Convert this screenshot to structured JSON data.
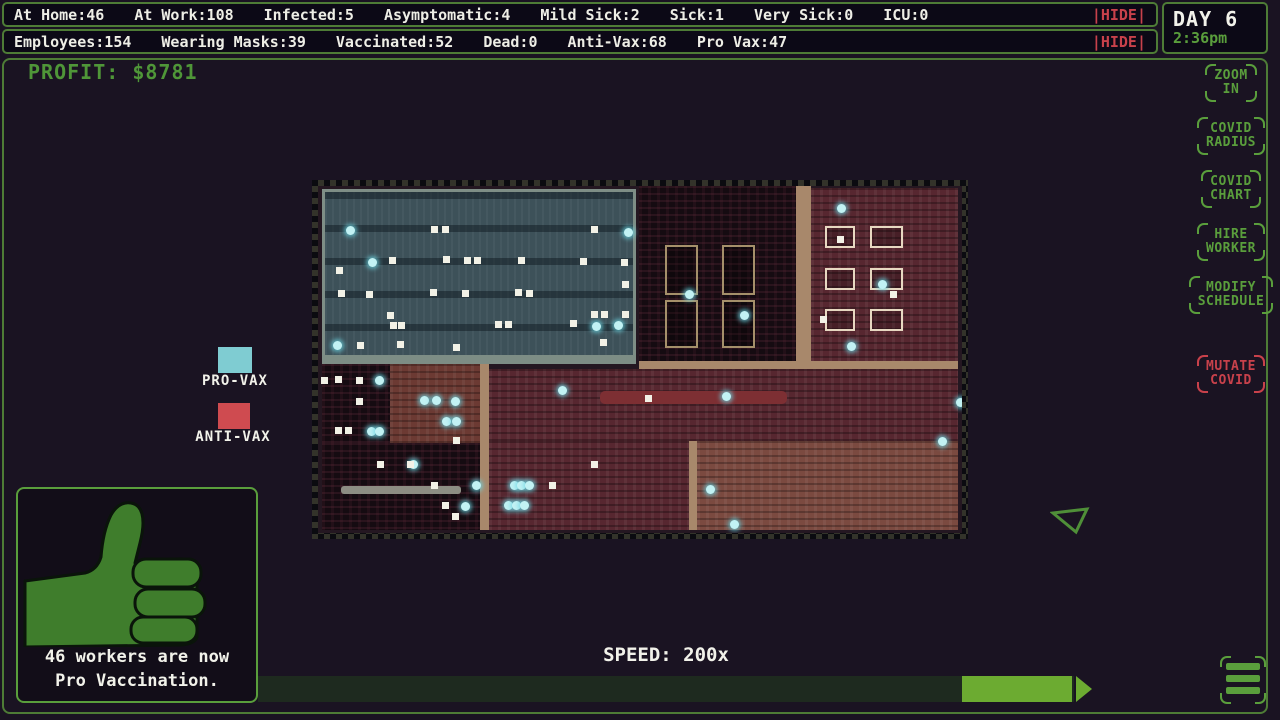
{
  "colors": {
    "accent_green": "#5a9e3c",
    "frame_green": "#4e7c36",
    "danger_red": "#c8414b",
    "profit_green": "#4f9638",
    "provax_cyan": "#7fccd2",
    "antivax_red": "#cf4b50",
    "speed_handle_green": "#6cab31"
  },
  "topbar1": {
    "stats": [
      "At Home:46",
      "At Work:108",
      "Infected:5",
      "Asymptomatic:4",
      "Mild Sick:2",
      "Sick:1",
      "Very Sick:0",
      "ICU:0"
    ],
    "hide_label": "|HIDE|"
  },
  "topbar2": {
    "stats": [
      "Employees:154",
      "Wearing Masks:39",
      "Vaccinated:52",
      "Dead:0",
      "Anti-Vax:68",
      "Pro Vax:47"
    ],
    "hide_label": "|HIDE|"
  },
  "clock": {
    "day": "DAY 6",
    "time": "2:36pm"
  },
  "profit": {
    "label": "PROFIT: $8781"
  },
  "legend": {
    "provax": "PRO-VAX",
    "antivax": "ANTI-VAX"
  },
  "buttons": [
    {
      "label": "ZOOM\nIN"
    },
    {
      "label": "COVID\nRADIUS"
    },
    {
      "label": "COVID\nCHART"
    },
    {
      "label": "HIRE\nWORKER"
    },
    {
      "label": "MODIFY\nSCHEDULE"
    },
    {
      "label": "MUTATE\nCOVID",
      "danger": true
    }
  ],
  "notification": {
    "icon": "thumbs-up-icon",
    "message": "46 workers are now\nPro Vaccination."
  },
  "speed": {
    "label": "SPEED: 200x"
  },
  "menu_icon": "hamburger-icon",
  "map": {
    "rooms": [
      {
        "x": 0.6,
        "y": 1.0,
        "w": 48.8,
        "h": 49.2,
        "t": "blue"
      },
      {
        "x": 49.8,
        "y": 0.0,
        "w": 24.4,
        "h": 50.4,
        "t": "dark"
      },
      {
        "x": 0.6,
        "y": 48.6,
        "w": 48.8,
        "h": 2.6,
        "t": "sidewalk"
      },
      {
        "x": 74.2,
        "y": 0.0,
        "w": 2.4,
        "h": 51.0,
        "t": "tan"
      },
      {
        "x": 76.6,
        "y": 0.6,
        "w": 22.8,
        "h": 49.8,
        "t": "maroon"
      },
      {
        "x": 49.8,
        "y": 50.4,
        "w": 49.6,
        "h": 2.2,
        "t": "tan"
      },
      {
        "x": 0.6,
        "y": 51.2,
        "w": 10.6,
        "h": 23.0,
        "t": "dark"
      },
      {
        "x": 11.2,
        "y": 51.2,
        "w": 14.0,
        "h": 23.0,
        "t": "red"
      },
      {
        "x": 25.2,
        "y": 51.2,
        "w": 1.4,
        "h": 48.0,
        "t": "tan"
      },
      {
        "x": 26.6,
        "y": 52.6,
        "w": 72.8,
        "h": 21.0,
        "t": "maroon"
      },
      {
        "x": 0.6,
        "y": 74.2,
        "w": 24.6,
        "h": 25.0,
        "t": "dark"
      },
      {
        "x": 26.6,
        "y": 73.6,
        "w": 31.0,
        "h": 25.6,
        "t": "maroon"
      },
      {
        "x": 57.6,
        "y": 73.6,
        "w": 1.2,
        "h": 25.6,
        "t": "tan"
      },
      {
        "x": 58.8,
        "y": 73.6,
        "w": 40.6,
        "h": 25.6,
        "t": "brown"
      }
    ],
    "structures": [
      {
        "x": 53.9,
        "y": 17.0,
        "w": 5.1,
        "h": 14.4,
        "s": "khaki"
      },
      {
        "x": 62.7,
        "y": 17.0,
        "w": 5.1,
        "h": 14.4,
        "s": "khaki"
      },
      {
        "x": 53.9,
        "y": 32.9,
        "w": 5.1,
        "h": 13.8,
        "s": "khaki"
      },
      {
        "x": 62.7,
        "y": 32.9,
        "w": 5.1,
        "h": 13.8,
        "s": "khaki"
      },
      {
        "x": 78.7,
        "y": 11.5,
        "w": 4.7,
        "h": 6.3,
        "s": "white"
      },
      {
        "x": 85.7,
        "y": 11.5,
        "w": 5.1,
        "h": 6.3,
        "s": "white"
      },
      {
        "x": 78.7,
        "y": 23.6,
        "w": 4.7,
        "h": 6.3,
        "s": "white"
      },
      {
        "x": 85.7,
        "y": 23.6,
        "w": 5.1,
        "h": 6.3,
        "s": "white"
      },
      {
        "x": 78.7,
        "y": 35.4,
        "w": 4.7,
        "h": 6.3,
        "s": "white"
      },
      {
        "x": 85.7,
        "y": 35.4,
        "w": 5.1,
        "h": 6.3,
        "s": "white"
      },
      {
        "x": 43.8,
        "y": 59.0,
        "w": 29.0,
        "h": 3.8,
        "s": "couch"
      },
      {
        "x": 3.6,
        "y": 86.5,
        "w": 18.6,
        "h": 2.2,
        "s": "gray"
      }
    ],
    "dots": [
      [
        4.3,
        11.5,
        "c"
      ],
      [
        47.5,
        12.1,
        "c"
      ],
      [
        7.8,
        20.7,
        "c"
      ],
      [
        46.0,
        38.9,
        "c"
      ],
      [
        2.3,
        44.7,
        "c"
      ],
      [
        42.5,
        39.2,
        "c"
      ],
      [
        57.0,
        30.0,
        "c"
      ],
      [
        65.5,
        36.0,
        "c"
      ],
      [
        80.6,
        5.2,
        "c"
      ],
      [
        87.0,
        27.1,
        "c"
      ],
      [
        82.1,
        45.0,
        "c"
      ],
      [
        8.9,
        54.8,
        "c"
      ],
      [
        7.6,
        69.5,
        "c"
      ],
      [
        8.9,
        69.5,
        "c"
      ],
      [
        15.8,
        60.5,
        "c"
      ],
      [
        17.7,
        60.5,
        "c"
      ],
      [
        20.7,
        60.8,
        "c"
      ],
      [
        19.3,
        66.6,
        "c"
      ],
      [
        20.8,
        66.6,
        "c"
      ],
      [
        14.1,
        79.0,
        "c"
      ],
      [
        23.9,
        85.0,
        "c"
      ],
      [
        22.2,
        91.1,
        "c"
      ],
      [
        37.3,
        57.6,
        "c"
      ],
      [
        29.8,
        85.0,
        "c"
      ],
      [
        30.9,
        85.0,
        "c"
      ],
      [
        32.1,
        85.0,
        "c"
      ],
      [
        28.9,
        90.8,
        "c"
      ],
      [
        30.1,
        90.8,
        "c"
      ],
      [
        31.4,
        90.8,
        "c"
      ],
      [
        62.7,
        59.4,
        "c"
      ],
      [
        60.2,
        86.2,
        "c"
      ],
      [
        64.0,
        96.3,
        "c"
      ],
      [
        96.3,
        72.3,
        "c"
      ],
      [
        99.0,
        61.0,
        "c"
      ],
      [
        17.5,
        11.5,
        "w"
      ],
      [
        19.3,
        11.5,
        "w"
      ],
      [
        42.4,
        11.5,
        "w"
      ],
      [
        11.0,
        20.5,
        "w"
      ],
      [
        19.4,
        20.2,
        "w"
      ],
      [
        22.7,
        20.5,
        "w"
      ],
      [
        24.2,
        20.5,
        "w"
      ],
      [
        31.1,
        20.5,
        "w"
      ],
      [
        40.7,
        20.7,
        "w"
      ],
      [
        47.0,
        21.0,
        "w"
      ],
      [
        2.8,
        23.3,
        "w"
      ],
      [
        47.2,
        27.4,
        "w"
      ],
      [
        3.1,
        30.0,
        "w"
      ],
      [
        7.5,
        30.3,
        "w"
      ],
      [
        17.4,
        29.7,
        "w"
      ],
      [
        22.4,
        30.0,
        "w"
      ],
      [
        30.6,
        29.7,
        "w"
      ],
      [
        32.3,
        30.0,
        "w"
      ],
      [
        10.7,
        36.3,
        "w"
      ],
      [
        11.2,
        39.2,
        "w"
      ],
      [
        12.4,
        39.2,
        "w"
      ],
      [
        27.5,
        38.9,
        "w"
      ],
      [
        29.0,
        38.9,
        "w"
      ],
      [
        39.1,
        38.6,
        "w"
      ],
      [
        42.4,
        36.0,
        "w"
      ],
      [
        43.9,
        36.0,
        "w"
      ],
      [
        47.2,
        36.0,
        "w"
      ],
      [
        6.1,
        45.0,
        "w"
      ],
      [
        12.3,
        44.7,
        "w"
      ],
      [
        21.0,
        45.5,
        "w"
      ],
      [
        43.8,
        44.1,
        "w"
      ],
      [
        80.6,
        14.4,
        "w"
      ],
      [
        88.8,
        30.3,
        "w"
      ],
      [
        0.5,
        55.0,
        "w"
      ],
      [
        2.6,
        54.8,
        "w"
      ],
      [
        5.9,
        55.0,
        "w"
      ],
      [
        5.9,
        61.1,
        "w"
      ],
      [
        2.6,
        69.5,
        "w"
      ],
      [
        4.2,
        69.5,
        "w"
      ],
      [
        9.2,
        79.3,
        "w"
      ],
      [
        13.8,
        79.3,
        "w"
      ],
      [
        17.5,
        85.3,
        "w"
      ],
      [
        19.3,
        91.1,
        "w"
      ],
      [
        20.8,
        94.2,
        "w"
      ],
      [
        21.0,
        72.3,
        "w"
      ],
      [
        35.9,
        85.3,
        "w"
      ],
      [
        42.4,
        79.3,
        "w"
      ],
      [
        50.8,
        60.2,
        "w"
      ],
      [
        78.0,
        37.5,
        "w"
      ]
    ]
  }
}
